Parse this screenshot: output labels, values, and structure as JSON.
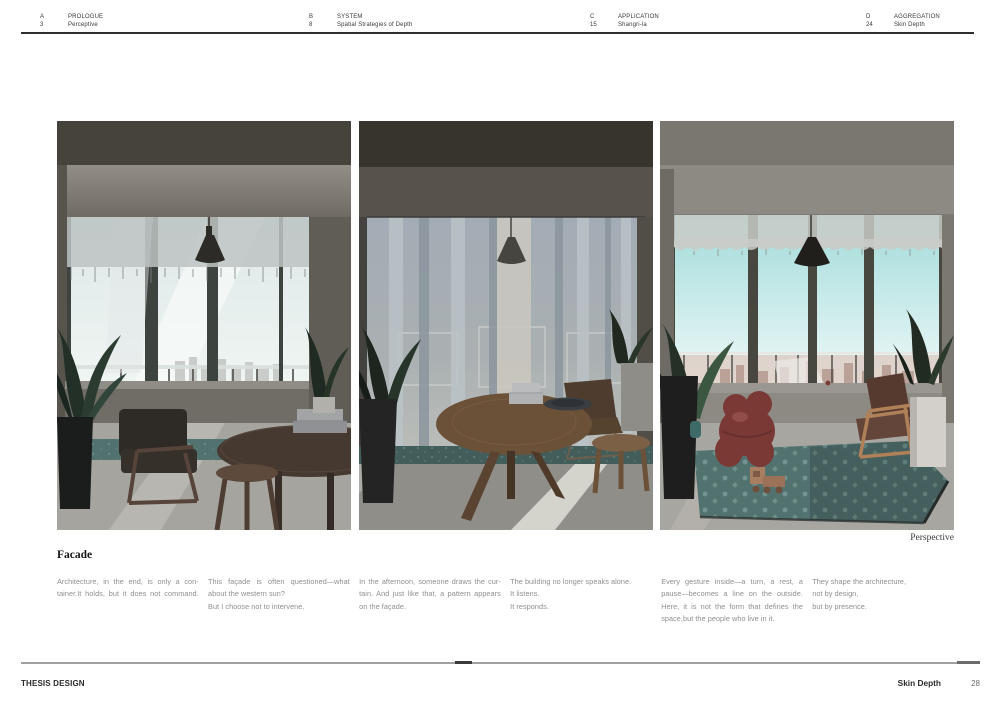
{
  "header": {
    "sections": [
      {
        "letter": "A",
        "number": "3",
        "title": "PROLOGUE",
        "subtitle": "Perceptive"
      },
      {
        "letter": "B",
        "number": "8",
        "title": "SYSTEM",
        "subtitle": "Spatial Strategies of Depth"
      },
      {
        "letter": "C",
        "number": "15",
        "title": "APPLICATION",
        "subtitle": "Shangri-la"
      },
      {
        "letter": "D",
        "number": "24",
        "title": "AGGREGATION",
        "subtitle": "Skin Depth"
      }
    ]
  },
  "figures": {
    "caption": "Perspective",
    "items": [
      {
        "description": "Interior render: morning, sheer valance over window, dark armchair, walnut table and stool"
      },
      {
        "description": "Interior render: afternoon, full-height sheer curtains drawn, round oak table with stool"
      },
      {
        "description": "Interior render: bright day, cyan sky, patterned teal rug, maroon sculpture, toy train, wood armchair"
      }
    ]
  },
  "essay": {
    "heading": "Facade",
    "columns": [
      {
        "lines": [
          "Architecture, in the end, is only a con-",
          "tainer.It holds, but it does not command."
        ]
      },
      {
        "lines": [
          "This façade is often questioned—what",
          "about the western sun?",
          "But I choose not to intervene."
        ]
      },
      {
        "lines": [
          "In the afternoon, someone draws the cur-",
          "tain. And just like that, a pattern appears",
          "on the façade."
        ]
      },
      {
        "lines": [
          "The building no longer speaks alone.",
          "It listens.",
          "It responds."
        ]
      },
      {
        "lines": [
          "Every gesture inside—a turn, a rest, a",
          "pause—becomes a line on the outside.",
          "Here, it is not the form that defines the",
          "space,but the people who live in it."
        ]
      },
      {
        "lines": [
          "They shape the architecture,",
          "not by design,",
          "but by presence."
        ]
      }
    ]
  },
  "footer": {
    "project": "THESIS DESIGN",
    "chapter": "Skin Depth",
    "page": "28"
  },
  "palette": {
    "rug_teal": "#527270",
    "sky_cyan": "#a2dbda",
    "maroon": "#7b3936",
    "oak": "#6b5138",
    "walnut": "#46392f"
  }
}
